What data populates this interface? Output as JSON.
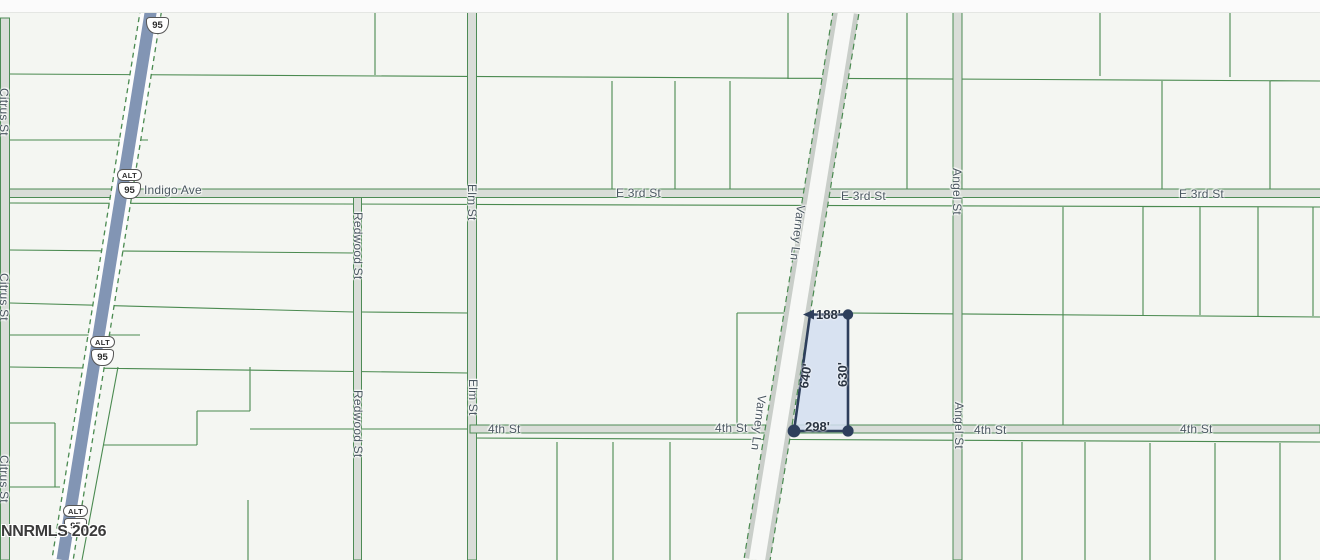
{
  "map": {
    "watermark": "NNRMLS 2026",
    "streets": {
      "citrus": "Citrus St",
      "indigo": "Indigo Ave",
      "e3rd": "E 3rd St",
      "elm": "Elm St",
      "redwood": "Redwood St",
      "varney": "Varney Ln",
      "angel": "Angel St",
      "fourth": "4th St"
    },
    "highway_shield": {
      "banner": "ALT",
      "route": "95"
    },
    "parcel_dimensions": {
      "top": "188'",
      "left": "640'",
      "right": "630'",
      "bottom": "298'"
    },
    "colors": {
      "background": "#f4f6f2",
      "parcel_line": "#4a8a50",
      "road_fill": "#d9ddd8",
      "highway_fill": "#8295b4",
      "varney_edge": "#c9cec9",
      "highlight_fill": "#d2def1",
      "highlight_stroke": "#2e3f5c",
      "street_label": "#4b5761"
    }
  }
}
